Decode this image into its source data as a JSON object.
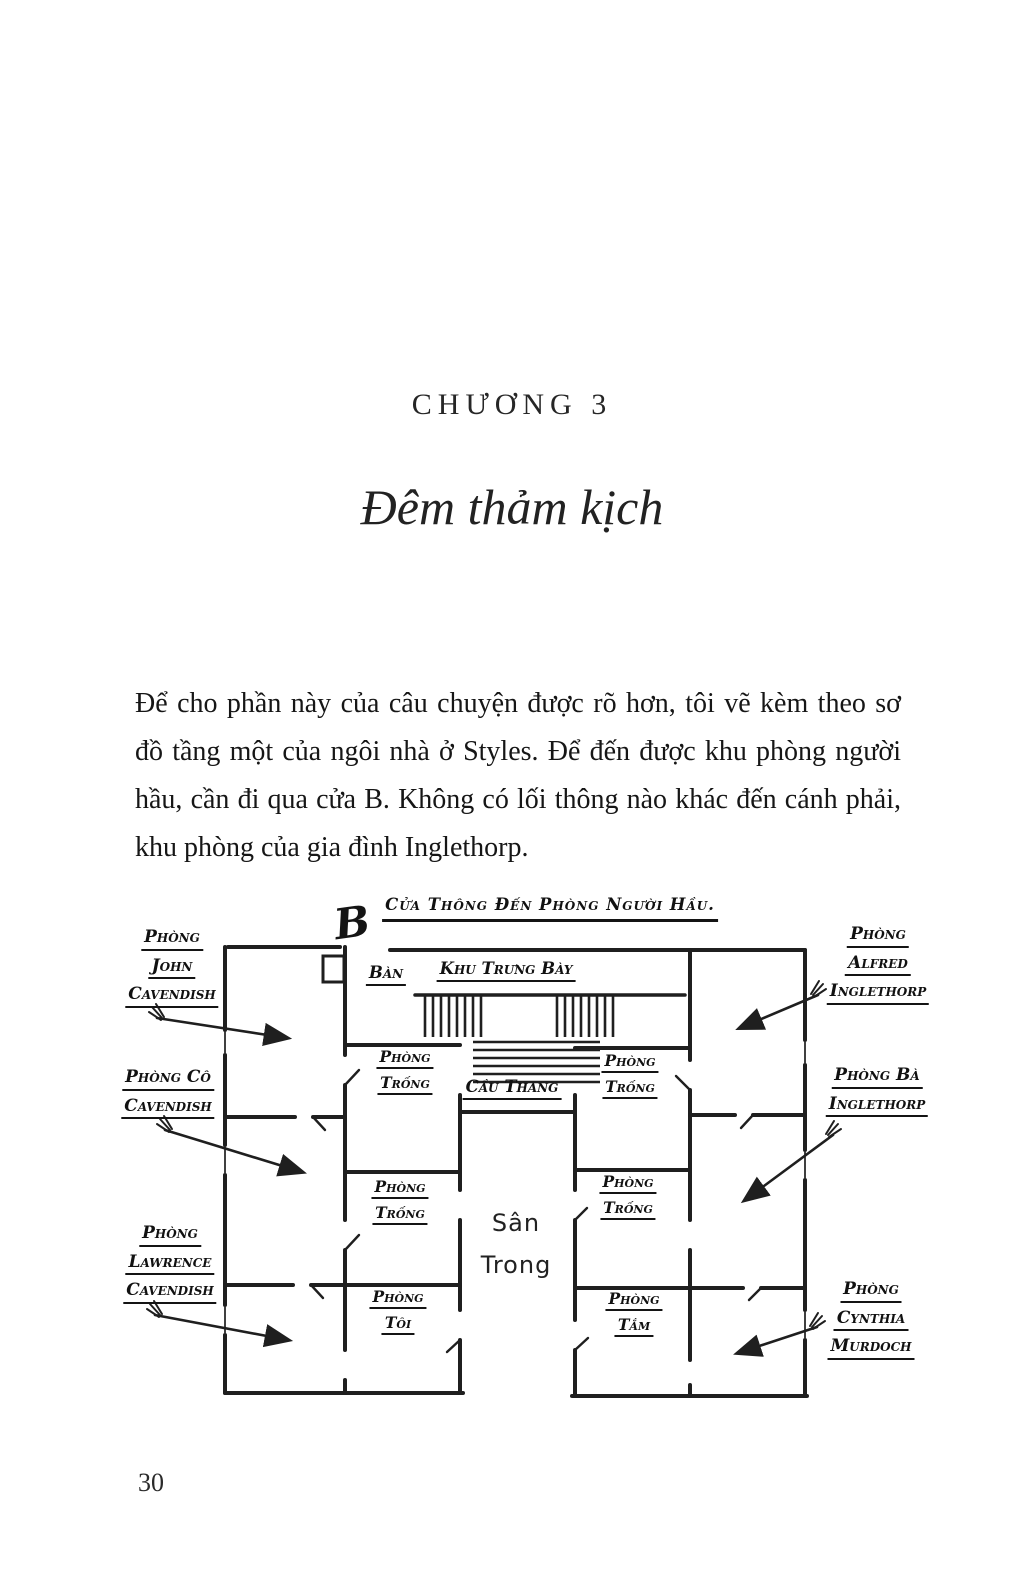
{
  "colors": {
    "ink": "#1c1c1c",
    "paper": "#ffffff"
  },
  "page": {
    "chapter_label": "CHƯƠNG 3",
    "chapter_title": "Đêm thảm kịch",
    "paragraph": "Để cho phần này của câu chuyện được rõ hơn, tôi vẽ kèm theo sơ đồ tầng một của ngôi nhà ở Styles. Để đến được khu phòng người hầu, cần đi qua cửa B. Không có lối thông nào khác đến cánh phải, khu phòng của gia đình Inglethorp.",
    "page_number": "30"
  },
  "diagram": {
    "door_letter": "B",
    "servants_door_label": "Cửa Thông Đến Phòng Người Hầu.",
    "table_label": "Bàn",
    "gallery_label": "Khu Trưng Bày",
    "staircase_label": "Cầu Thang",
    "courtyard_label": {
      "line1": "Sân",
      "line2": "Trong"
    },
    "left_wing_rooms": [
      {
        "lines": [
          "Phòng",
          "John",
          "Cavendish"
        ]
      },
      {
        "lines": [
          "Phòng Cô",
          "Cavendish"
        ]
      },
      {
        "lines": [
          "Phòng",
          "Lawrence",
          "Cavendish"
        ]
      }
    ],
    "right_wing_rooms": [
      {
        "lines": [
          "Phòng",
          "Alfred",
          "Inglethorp"
        ]
      },
      {
        "lines": [
          "Phòng Bà",
          "Inglethorp"
        ]
      },
      {
        "lines": [
          "Phòng",
          "Cynthia",
          "Murdoch"
        ]
      }
    ],
    "inner_rooms_left": [
      {
        "lines": [
          "Phòng",
          "Trống"
        ]
      },
      {
        "lines": [
          "Phòng",
          "Trống"
        ]
      },
      {
        "lines": [
          "Phòng",
          "Tôi"
        ]
      }
    ],
    "inner_rooms_right": [
      {
        "lines": [
          "Phòng",
          "Trống"
        ]
      },
      {
        "lines": [
          "Phòng",
          "Trống"
        ]
      },
      {
        "lines": [
          "Phòng",
          "Tắm"
        ]
      }
    ]
  }
}
